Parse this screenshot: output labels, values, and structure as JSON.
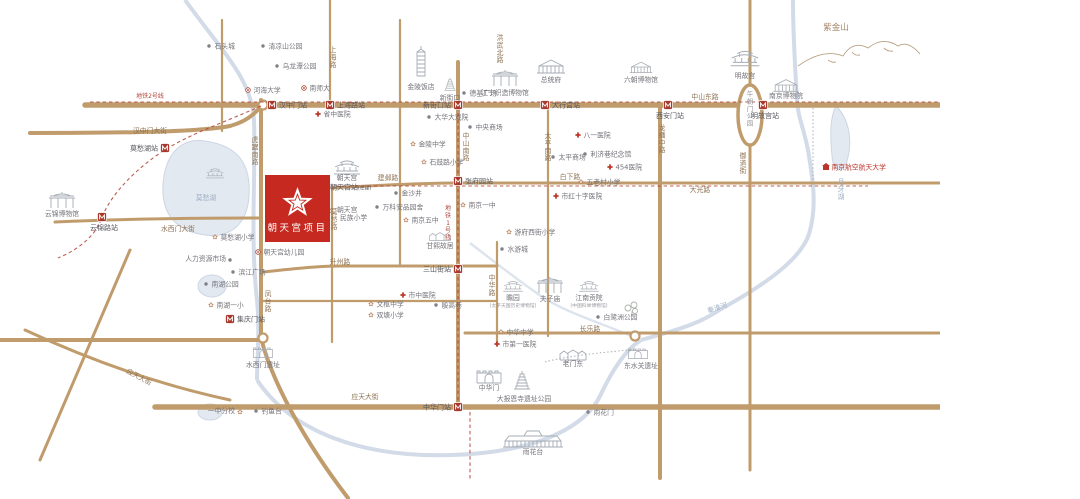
{
  "panel": {
    "title_top": "朝天宫",
    "title_num": "G17",
    "title_bottom": "项目",
    "english": "CHIAXIA DEVELOPMENT CHAOTIANGONG PROJECT",
    "sub": [
      "区",
      "位",
      "图"
    ]
  },
  "project": {
    "name": "朝天宫项目"
  },
  "colors": {
    "accent_red": "#c5291f",
    "road_tan": "#c09c6d",
    "water_blue": "#d2dbe7",
    "title_bronze": "#a5825f",
    "metro_red": "#a8382c"
  },
  "map": {
    "road_labels": [
      {
        "t": "汉中门大街",
        "x": 150,
        "y": 133
      },
      {
        "t": "中山东路",
        "x": 705,
        "y": 99
      },
      {
        "t": "建邺路",
        "x": 388,
        "y": 180
      },
      {
        "t": "白下路",
        "x": 570,
        "y": 179
      },
      {
        "t": "大光路",
        "x": 700,
        "y": 192
      },
      {
        "t": "升州路",
        "x": 340,
        "y": 264
      },
      {
        "t": "长乐路",
        "x": 590,
        "y": 331
      },
      {
        "t": "应天大街",
        "x": 365,
        "y": 399
      },
      {
        "t": "应天大街",
        "x": 138,
        "y": 379,
        "rot": 28
      },
      {
        "t": "水西门大街",
        "x": 178,
        "y": 231
      },
      {
        "t": "上海路",
        "x": 333,
        "y": 52,
        "v": 1
      },
      {
        "t": "洪武北路",
        "x": 500,
        "y": 40,
        "v": 1
      },
      {
        "t": "中山南路",
        "x": 466,
        "y": 138,
        "v": 1
      },
      {
        "t": "太平南路",
        "x": 548,
        "y": 138,
        "v": 1
      },
      {
        "t": "中华路",
        "x": 492,
        "y": 280,
        "v": 1
      },
      {
        "t": "龙蟠中路",
        "x": 662,
        "y": 130,
        "v": 1
      },
      {
        "t": "御道街",
        "x": 743,
        "y": 158,
        "v": 1
      },
      {
        "t": "莫愁路",
        "x": 334,
        "y": 214,
        "v": 1
      },
      {
        "t": "虎踞南路",
        "x": 255,
        "y": 142,
        "v": 1
      },
      {
        "t": "凤台路",
        "x": 268,
        "y": 296,
        "v": 1
      },
      {
        "t": "午朝门公园",
        "x": 750,
        "y": 96,
        "v": 1,
        "cls": "park"
      },
      {
        "t": "地铁1号线",
        "x": 448,
        "y": 210,
        "v": 1,
        "cls": "metro"
      },
      {
        "t": "地铁2号线",
        "x": 150,
        "y": 98,
        "cls": "metro"
      },
      {
        "t": "秦淮河",
        "x": 718,
        "y": 310,
        "cls": "water",
        "rot": -18
      },
      {
        "t": "月牙湖",
        "x": 841,
        "y": 184,
        "v": 1,
        "cls": "water"
      }
    ],
    "stations": [
      {
        "t": "汉中门站",
        "x": 272,
        "y": 105,
        "pos": "r"
      },
      {
        "t": "上海路站",
        "x": 330,
        "y": 105,
        "pos": "r"
      },
      {
        "t": "新街口站",
        "x": 458,
        "y": 105,
        "pos": "l"
      },
      {
        "t": "大行宫站",
        "x": 545,
        "y": 105,
        "pos": "r"
      },
      {
        "t": "西安门站",
        "x": 668,
        "y": 105,
        "pos": "b"
      },
      {
        "t": "明故宫站",
        "x": 763,
        "y": 105,
        "pos": "b"
      },
      {
        "t": "张府园站",
        "x": 458,
        "y": 181,
        "pos": "r"
      },
      {
        "t": "三山街站",
        "x": 458,
        "y": 269,
        "pos": "l"
      },
      {
        "t": "中华门站",
        "x": 458,
        "y": 407,
        "pos": "l"
      },
      {
        "t": "朝天宫站",
        "x": 323,
        "y": 187,
        "pos": "r",
        "note": "(在建)"
      },
      {
        "t": "莫愁湖站",
        "x": 165,
        "y": 148,
        "pos": "l"
      },
      {
        "t": "云锦路站",
        "x": 102,
        "y": 217,
        "pos": "b"
      },
      {
        "t": "集庆门站",
        "x": 230,
        "y": 319,
        "pos": "r"
      }
    ],
    "landmarks": [
      {
        "t": "朝天宫",
        "x": 347,
        "y": 180,
        "a": "m",
        "sk": "temple",
        "sx": 347,
        "sy": 167
      },
      {
        "t": "金陵饭店",
        "x": 421,
        "y": 89,
        "a": "m",
        "sk": "tower",
        "sx": 421,
        "sy": 66
      },
      {
        "t": "新街口",
        "x": 450,
        "y": 100,
        "a": "m",
        "sk": "pagoda",
        "sx": 450,
        "sy": 84,
        "ss": 0.7
      },
      {
        "t": "江宁织造博物馆",
        "x": 505,
        "y": 95,
        "a": "m",
        "sk": "arch",
        "sx": 505,
        "sy": 78
      },
      {
        "t": "总统府",
        "x": 551,
        "y": 82,
        "a": "m",
        "sk": "palace",
        "sx": 551,
        "sy": 66
      },
      {
        "t": "六朝博物馆",
        "x": 641,
        "y": 82,
        "a": "m",
        "sk": "palace",
        "sx": 641,
        "sy": 67,
        "ss": 0.8
      },
      {
        "t": "明故宫",
        "x": 745,
        "y": 78,
        "a": "m",
        "sk": "temple",
        "sx": 745,
        "sy": 58,
        "ss": 1.1
      },
      {
        "t": "南京博物院",
        "x": 786,
        "y": 98,
        "a": "m",
        "sk": "palace",
        "sx": 786,
        "sy": 85,
        "ss": 0.9
      },
      {
        "t": "紫金山",
        "x": 836,
        "y": 30,
        "a": "m",
        "cls": "mtn",
        "sk": "mountain",
        "sx": 858,
        "sy": 50
      },
      {
        "t": "云锦博物馆",
        "x": 62,
        "y": 216,
        "a": "m",
        "sk": "arch",
        "sx": 62,
        "sy": 200
      },
      {
        "t": "甘熙故居",
        "x": 440,
        "y": 248,
        "a": "m",
        "sk": "houses",
        "sx": 440,
        "sy": 235,
        "ss": 0.8
      },
      {
        "t": "瞻园",
        "x": 513,
        "y": 300,
        "a": "m",
        "sub": "(太平天国历史博物馆)",
        "sk": "temple",
        "sx": 513,
        "sy": 286,
        "ss": 0.75
      },
      {
        "t": "夫子庙",
        "x": 550,
        "y": 301,
        "a": "m",
        "sk": "arch",
        "sx": 550,
        "sy": 285
      },
      {
        "t": "江南贡院",
        "x": 589,
        "y": 300,
        "a": "m",
        "sub": "(中国科举博物馆)",
        "sk": "temple",
        "sx": 589,
        "sy": 286,
        "ss": 0.75
      },
      {
        "t": "老门东",
        "x": 573,
        "y": 366,
        "a": "m",
        "sk": "houses",
        "sx": 573,
        "sy": 353
      },
      {
        "t": "东水关遗址",
        "x": 641,
        "y": 368,
        "a": "m",
        "sk": "gate",
        "sx": 638,
        "sy": 353,
        "ss": 0.8
      },
      {
        "t": "中华门",
        "x": 489,
        "y": 390,
        "a": "m",
        "sk": "gate",
        "sx": 489,
        "sy": 376
      },
      {
        "t": "大报恩寺遗址公园",
        "x": 524,
        "y": 401,
        "a": "m",
        "sk": "pagoda",
        "sx": 522,
        "sy": 380
      },
      {
        "t": "雨花台",
        "x": 533,
        "y": 454,
        "a": "m",
        "sk": "bigpalace",
        "sx": 533,
        "sy": 438
      },
      {
        "t": "水西门遗址",
        "x": 263,
        "y": 367,
        "a": "m",
        "sk": "gate",
        "sx": 263,
        "sy": 352,
        "ss": 0.8
      },
      {
        "t": "莫愁湖",
        "x": 206,
        "y": 200,
        "a": "m",
        "cls": "water",
        "sk": "temple",
        "sx": 215,
        "sy": 173,
        "ss": 0.7
      },
      {
        "t": "白鹭洲公园",
        "icon": "dot",
        "x": 598,
        "y": 317,
        "sk": "trees",
        "sx": 632,
        "sy": 308
      },
      {
        "t": "石头城",
        "icon": "dot",
        "x": 209,
        "y": 46
      },
      {
        "t": "清凉山公园",
        "icon": "dot",
        "x": 263,
        "y": 46
      },
      {
        "t": "乌龙潭公园",
        "icon": "dot",
        "x": 277,
        "y": 66
      },
      {
        "t": "德基广场",
        "icon": "dot",
        "x": 464,
        "y": 93
      },
      {
        "t": "大华大戏院",
        "icon": "dot",
        "x": 429,
        "y": 117
      },
      {
        "t": "中央商场",
        "icon": "dot",
        "x": 470,
        "y": 127
      },
      {
        "t": "太平商场",
        "icon": "dot",
        "x": 553,
        "y": 157
      },
      {
        "t": "利济巷纪念馆",
        "icon": "dot",
        "x": 585,
        "y": 154
      },
      {
        "t": "万科安品园舍",
        "icon": "dot",
        "x": 377,
        "y": 207
      },
      {
        "t": "金沙井",
        "icon": "dot",
        "x": 396,
        "y": 193
      },
      {
        "t": "水游城",
        "icon": "dot",
        "x": 502,
        "y": 249
      },
      {
        "t": "雨花门",
        "icon": "dot",
        "x": 588,
        "y": 412
      },
      {
        "t": "钓鱼台",
        "icon": "dot",
        "x": 256,
        "y": 411
      },
      {
        "t": "殷高巷",
        "icon": "dot",
        "x": 436,
        "y": 305
      },
      {
        "t": "南湖公园",
        "icon": "dot",
        "x": 206,
        "y": 284
      },
      {
        "t": "滨江广场",
        "icon": "dot",
        "x": 233,
        "y": 272
      },
      {
        "t": "人力资源市场",
        "icon": "dot",
        "x": 230,
        "y": 260,
        "a": "e",
        "lx": 226,
        "ly": 261
      },
      {
        "t": "朝天宫",
        "t2": "民族小学",
        "icon": "flower",
        "x": 330,
        "y": 211,
        "lx": 337,
        "ly": 212
      },
      {
        "t": "石鼓路小学",
        "icon": "flower",
        "x": 424,
        "y": 162
      },
      {
        "t": "金陵中学",
        "icon": "flower",
        "x": 413,
        "y": 144
      },
      {
        "t": "南京五中",
        "icon": "flower",
        "x": 406,
        "y": 220
      },
      {
        "t": "南京一中",
        "icon": "flower",
        "x": 463,
        "y": 205
      },
      {
        "t": "游府西街小学",
        "icon": "flower",
        "x": 509,
        "y": 232
      },
      {
        "t": "中华中学",
        "icon": "flower",
        "x": 501,
        "y": 332
      },
      {
        "t": "双塘小学",
        "icon": "flower",
        "x": 371,
        "y": 315
      },
      {
        "t": "文枢中学",
        "icon": "flower",
        "x": 371,
        "y": 304
      },
      {
        "t": "莫愁湖小学",
        "icon": "flower",
        "x": 215,
        "y": 237
      },
      {
        "t": "南湖一小",
        "icon": "flower",
        "x": 211,
        "y": 305
      },
      {
        "t": "五老村小学",
        "icon": "flower",
        "x": 581,
        "y": 182
      },
      {
        "t": "一中分校",
        "icon": "flower",
        "x": 240,
        "y": 412,
        "a": "e",
        "lx": 235,
        "ly": 413
      },
      {
        "t": "河海大学",
        "icon": "uni",
        "x": 248,
        "y": 90
      },
      {
        "t": "南师大",
        "icon": "uni",
        "x": 304,
        "y": 88
      },
      {
        "t": "朝天宫幼儿园",
        "icon": "uni",
        "x": 258,
        "y": 252
      },
      {
        "t": "省中医院",
        "icon": "cross",
        "x": 318,
        "y": 114
      },
      {
        "t": "市红十字医院",
        "icon": "cross",
        "x": 556,
        "y": 196
      },
      {
        "t": "八一医院",
        "icon": "cross",
        "x": 578,
        "y": 135
      },
      {
        "t": "454医院",
        "icon": "cross",
        "x": 610,
        "y": 167
      },
      {
        "t": "市第一医院",
        "icon": "cross",
        "x": 497,
        "y": 344
      },
      {
        "t": "市中医院",
        "icon": "cross",
        "x": 403,
        "y": 295
      },
      {
        "t": "南京航空航天大学",
        "icon": "red",
        "x": 826,
        "y": 167,
        "cls": "red"
      }
    ]
  }
}
